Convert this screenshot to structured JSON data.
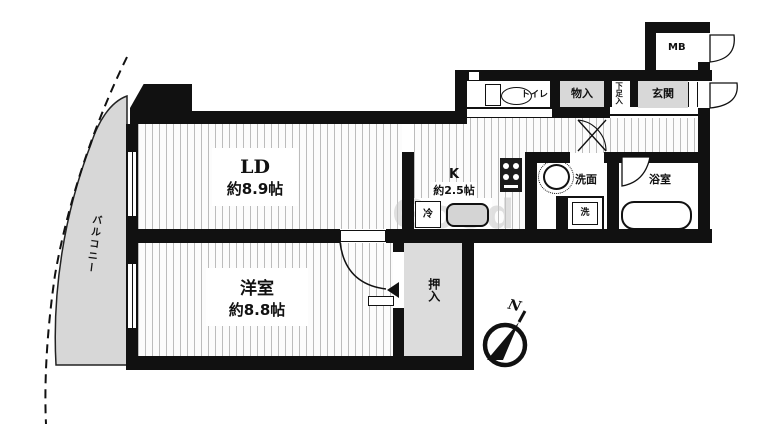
{
  "plan": {
    "title": "apartment-floor-plan",
    "watermark": "Good",
    "compass_label": "N",
    "rooms": {
      "ld": {
        "name": "LD",
        "size": "約8.9帖"
      },
      "bedroom": {
        "name": "洋室",
        "size": "約8.8帖"
      },
      "kitchen": {
        "name": "K",
        "size": "約2.5帖"
      },
      "balcony": {
        "name": "バルコニー"
      },
      "closet": {
        "name": "押入"
      },
      "storage": {
        "name": "物入"
      },
      "shoe_cabinet": {
        "name": "下足入"
      },
      "entrance": {
        "name": "玄関"
      },
      "meter_box": {
        "name": "MB"
      },
      "toilet": {
        "name": "トイレ"
      },
      "washroom": {
        "name": "洗面"
      },
      "washer": {
        "name": "洗"
      },
      "bathroom": {
        "name": "浴室"
      },
      "refrigerator": {
        "name": "冷"
      }
    },
    "colors": {
      "wall": "#111111",
      "stripe": "#bcbcbc",
      "closet_fill": "#dcdcdc",
      "entrance_fill": "#d8d8d8",
      "balcony_fill": "#d7d7d7"
    }
  }
}
